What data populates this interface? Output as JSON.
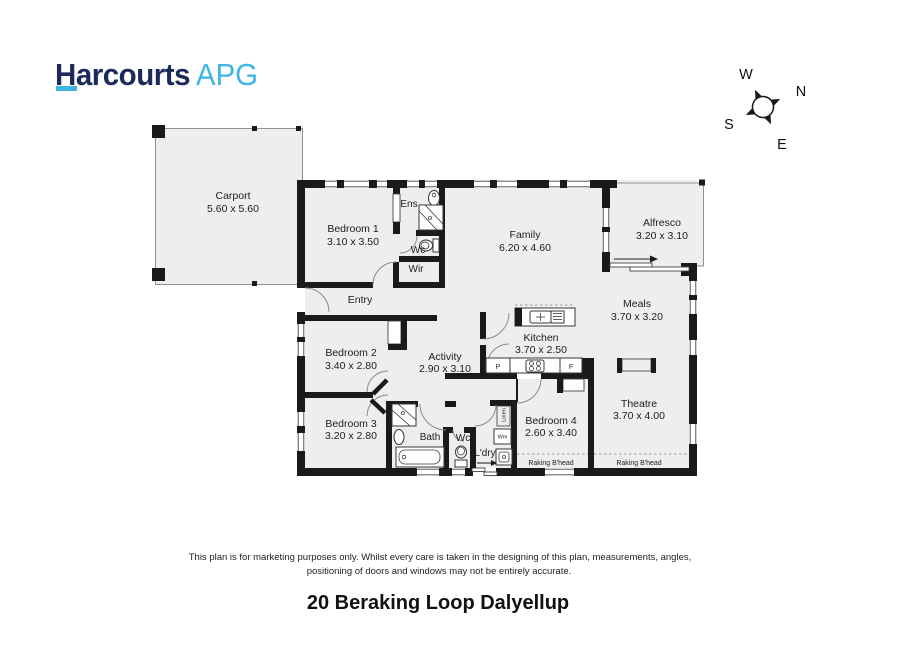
{
  "logo": {
    "brand": "Harcourts",
    "suffix": "APG"
  },
  "brand_colors": {
    "navy": "#1b2a5a",
    "light_blue": "#3fb4e5"
  },
  "plan_colors": {
    "wall": "#1a1a1a",
    "floor_fill": "#eceef0"
  },
  "compass": {
    "n": "N",
    "s": "S",
    "e": "E",
    "w": "W"
  },
  "rooms": {
    "carport": {
      "name": "Carport",
      "dims": "5.60 x 5.60"
    },
    "bedroom1": {
      "name": "Bedroom 1",
      "dims": "3.10 x 3.50"
    },
    "family": {
      "name": "Family",
      "dims": "6.20 x 4.60"
    },
    "alfresco": {
      "name": "Alfresco",
      "dims": "3.20 x 3.10"
    },
    "meals": {
      "name": "Meals",
      "dims": "3.70 x 3.20"
    },
    "kitchen": {
      "name": "Kitchen",
      "dims": "3.70 x 2.50"
    },
    "bedroom2": {
      "name": "Bedroom 2",
      "dims": "3.40 x 2.80"
    },
    "activity": {
      "name": "Activity",
      "dims": "2.90 x 3.10"
    },
    "theatre": {
      "name": "Theatre",
      "dims": "3.70 x 4.00"
    },
    "bedroom3": {
      "name": "Bedroom 3",
      "dims": "3.20 x 2.80"
    },
    "bedroom4": {
      "name": "Bedroom 4",
      "dims": "2.60 x 3.40"
    }
  },
  "small_labels": {
    "entry": "Entry",
    "ens": "Ens",
    "wc_upper": "Wc",
    "wir": "Wir",
    "bath": "Bath",
    "wc_lower": "Wc",
    "laundry": "L'dry",
    "wm": "Wm",
    "linen": "Linen",
    "pantry": "P",
    "fridge": "F",
    "raking_bulkhead_left": "Raking B'head",
    "raking_bulkhead_right": "Raking B'head"
  },
  "footer": {
    "disclaimer_line1": "This plan is for marketing purposes only. Whilst every care is taken in the designing of this plan, measurements, angles,",
    "disclaimer_line2": "positioning of doors and windows may not be entirely accurate.",
    "address": "20 Beraking Loop Dalyellup"
  }
}
